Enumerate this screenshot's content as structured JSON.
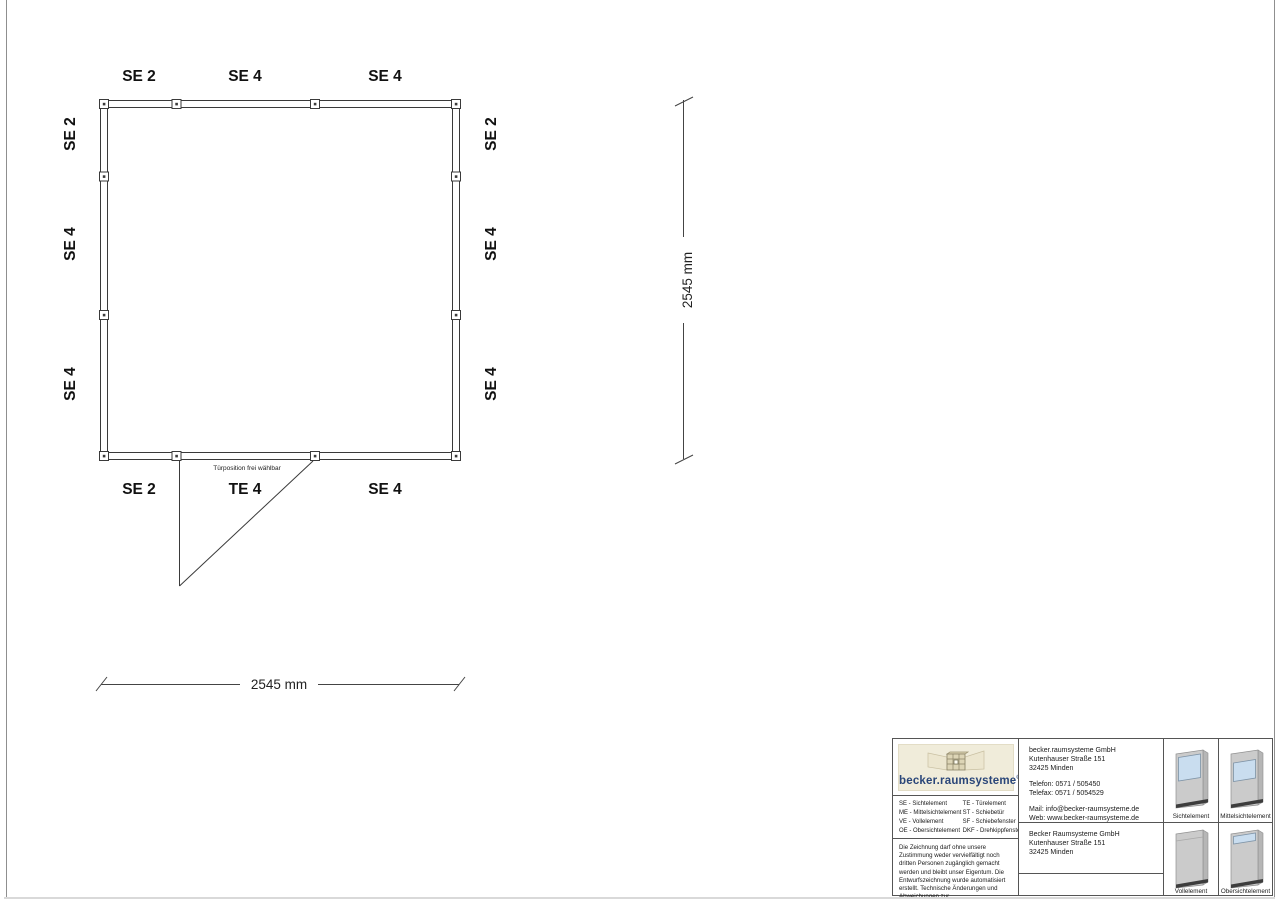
{
  "plan": {
    "top_labels": [
      "SE 2",
      "SE 4",
      "SE 4"
    ],
    "bottom_labels": [
      "SE 2",
      "TE 4",
      "SE 4"
    ],
    "left_labels": [
      "SE 2",
      "SE 4",
      "SE 4"
    ],
    "right_labels": [
      "SE 2",
      "SE 4",
      "SE 4"
    ],
    "door_note": "Türposition frei wählbar",
    "dimension_horizontal": "2545 mm",
    "dimension_vertical": "2545 mm"
  },
  "titleblock": {
    "logo": {
      "wordmark": "becker.raumsysteme",
      "registered": "®"
    },
    "legend": {
      "col1": [
        "SE - Sichtelement",
        "ME - Mittelsichtelement",
        "VE - Vollelement",
        "OE - Obersichtelement"
      ],
      "col2": [
        "TE - Türelement",
        "ST - Schiebetür",
        "SF - Schiebefenster",
        "DKF - Drehkippfenster"
      ]
    },
    "disclaimer": "Die Zeichnung darf ohne unsere Zustimmung weder vervielfältigt noch dritten Personen zugänglich gemacht werden und bleibt unser Eigentum. Die Entwurfszeichnung wurde automatisiert erstellt. Technische Änderungen und Abweichungen zur Ausführungszeichnung behalten wir uns vor.",
    "manufacturer": {
      "name": "becker.raumsysteme GmbH",
      "street": "Kutenhauser Straße 151",
      "city": "32425 Minden",
      "phone": "Telefon: 0571 / 505450",
      "fax": "Telefax: 0571 / 5054529",
      "mail": "Mail: info@becker-raumsysteme.de",
      "web": "Web: www.becker-raumsysteme.de"
    },
    "customer": {
      "name": "Becker Raumsysteme GmbH",
      "street": "Kutenhauser Straße 151",
      "city": "32425 Minden"
    },
    "elements": [
      {
        "label": "Sichtelement"
      },
      {
        "label": "Mittelsichtelement"
      },
      {
        "label": "Vollelement"
      },
      {
        "label": "Obersichtelement"
      }
    ]
  },
  "colors": {
    "line": "#3a3a3a",
    "logo_blue": "#2a4679",
    "logo_beige": "#f0ecda",
    "glass": "#c9ddef",
    "panel_gray": "#cbcbcb",
    "base_dark": "#3d3d3d"
  }
}
